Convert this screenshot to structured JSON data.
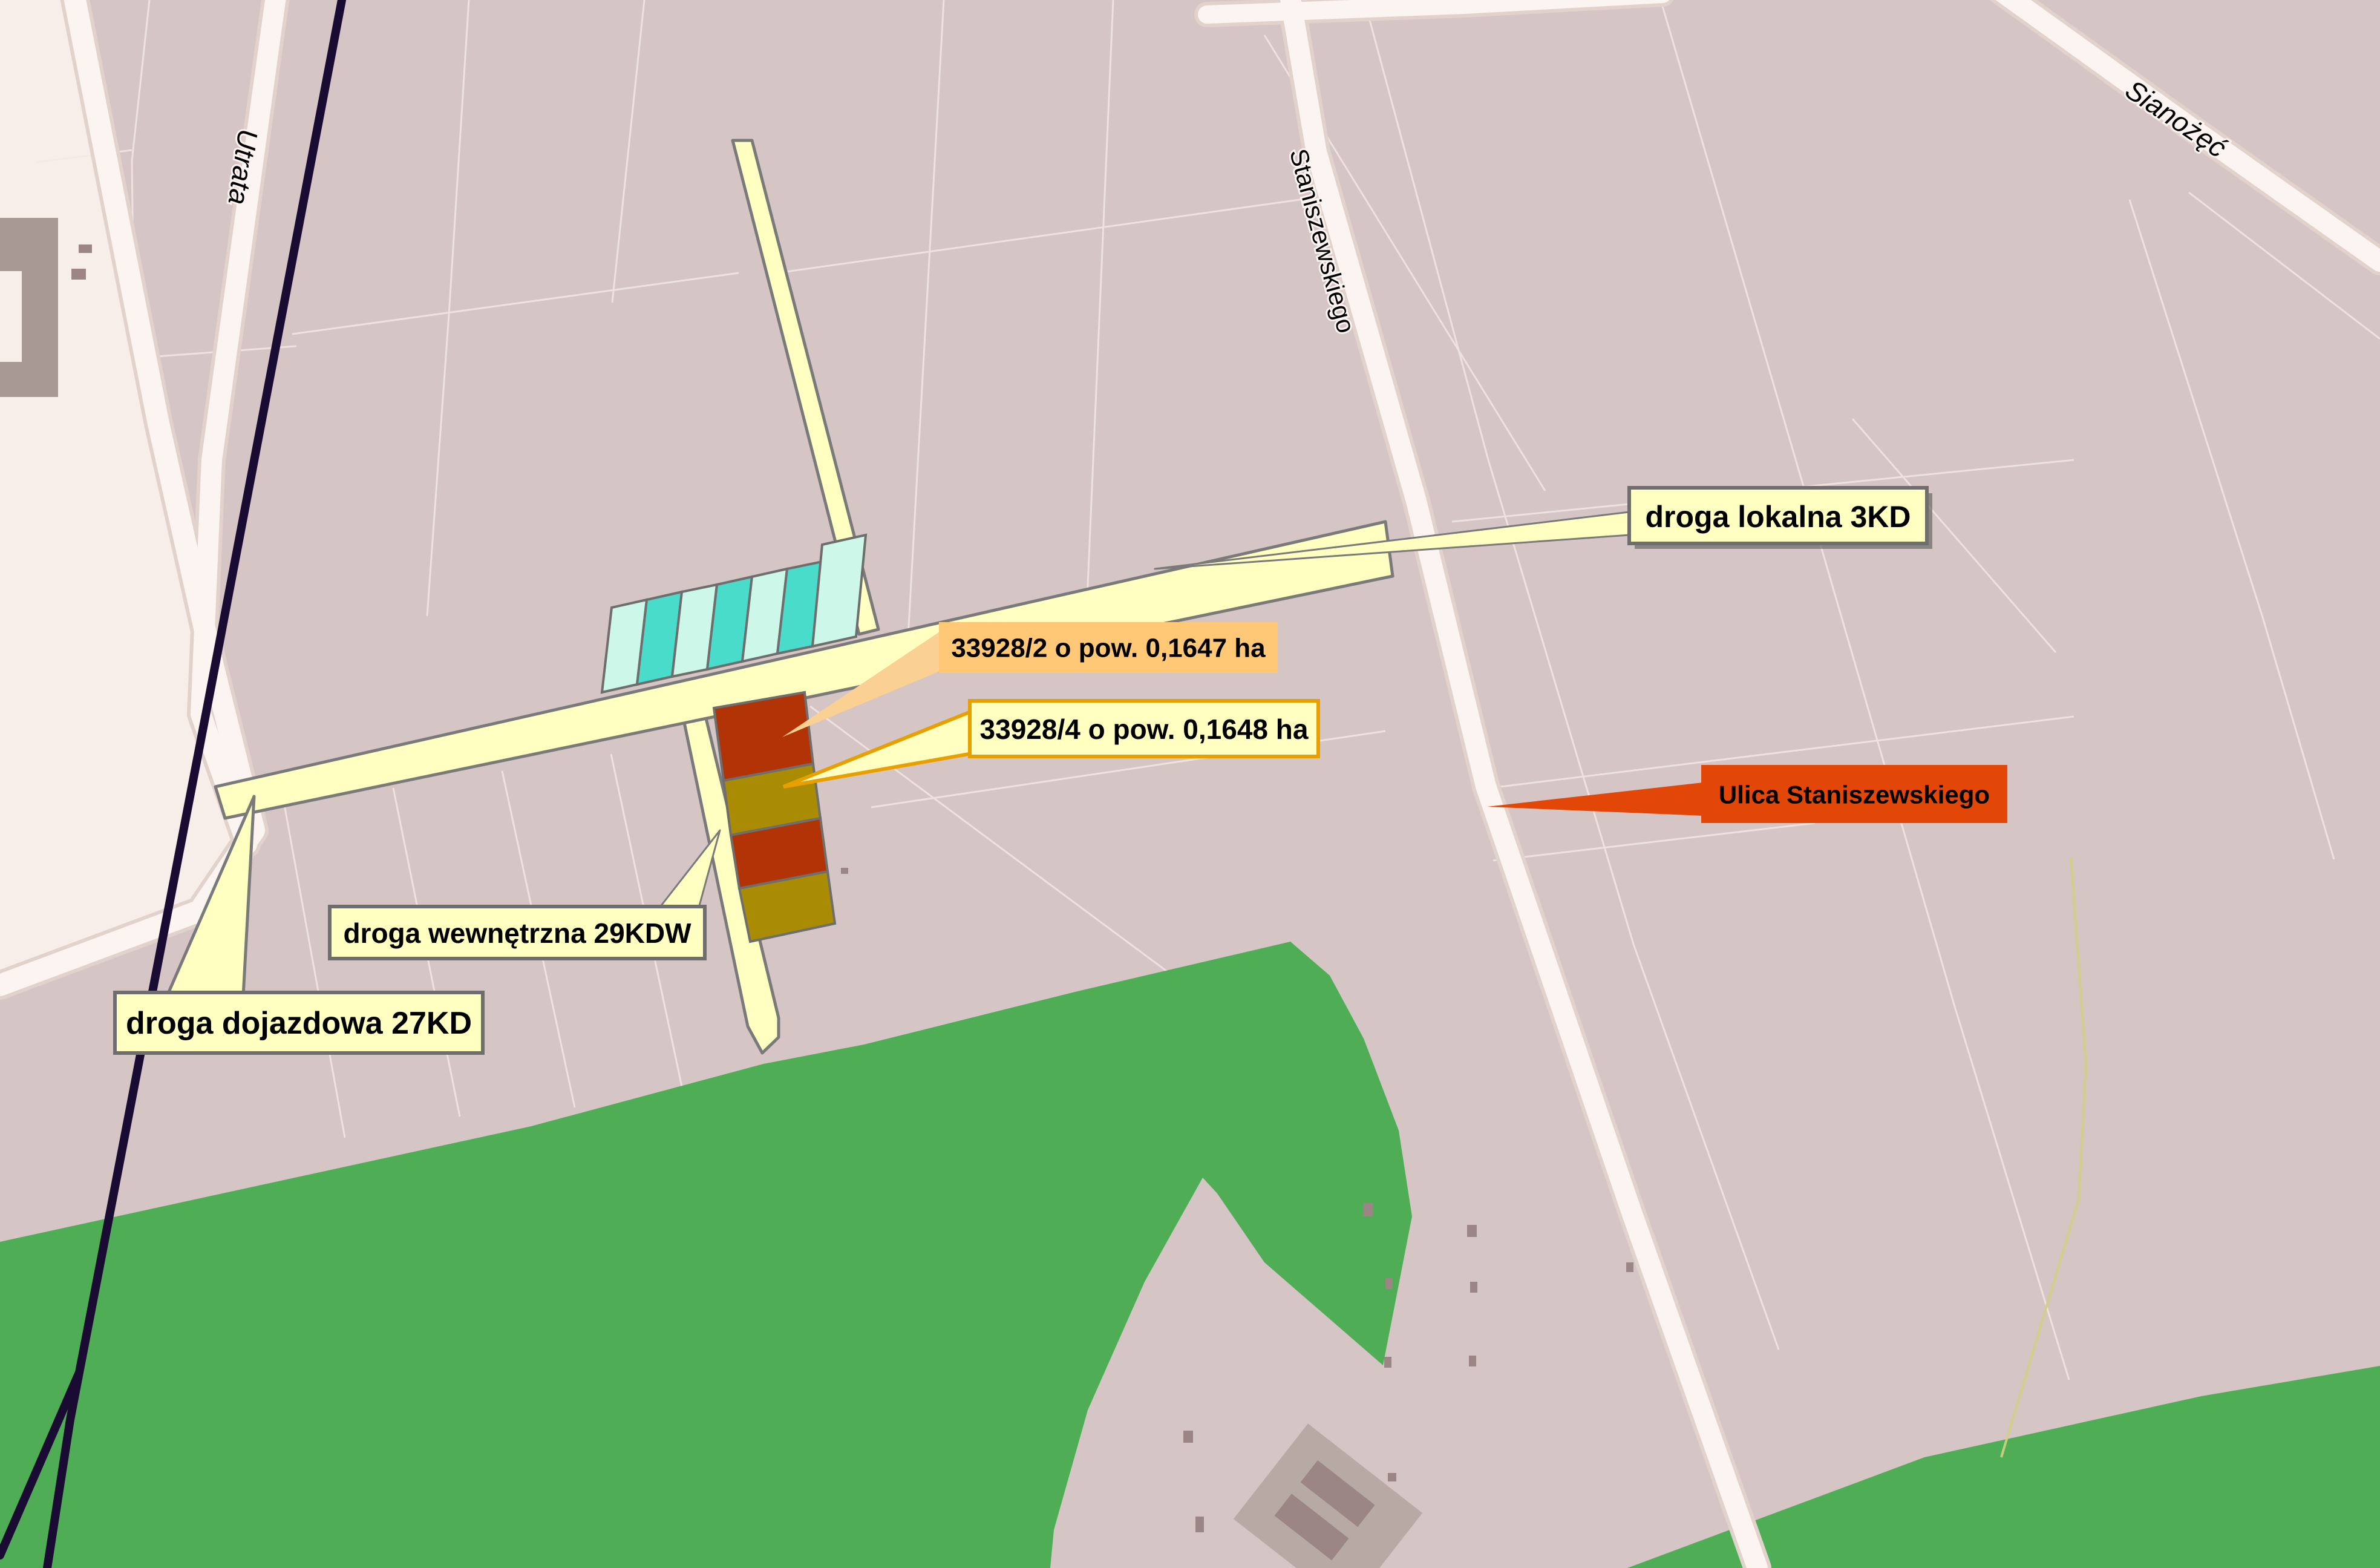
{
  "map": {
    "streets": [
      {
        "name": "Utrata"
      },
      {
        "name": "Staniszewskiego"
      },
      {
        "name": "Sianożęć"
      }
    ],
    "callouts": [
      {
        "id": "droga-lokalna-3kd",
        "label": "droga lokalna 3KD"
      },
      {
        "id": "parcel-33928-2",
        "label": "33928/2 o pow. 0,1647 ha"
      },
      {
        "id": "parcel-33928-4",
        "label": "33928/4 o pow. 0,1648 ha"
      },
      {
        "id": "ulica-staniszewskiego",
        "label": "Ulica Staniszewskiego"
      },
      {
        "id": "droga-wewnetrzna-29kdw",
        "label": "droga wewnętrzna 29KDW"
      },
      {
        "id": "droga-dojazdowa-27kd",
        "label": "droga dojazdowa 27KD"
      }
    ],
    "palette": {
      "base": "#d5c5c5",
      "pale_area": "#f7eeea",
      "parcel_line": "#f2e8e4",
      "olive_line": "#d2cf7f",
      "green": "#4fae55",
      "road_fill": "#fcf4f0",
      "road_casing": "#e2d2cc",
      "railway": "#1a0b33",
      "cream": "#ffffc1",
      "cream_border": "#7a7a7a",
      "cyan_light": "#cdf7e9",
      "cyan_bright": "#4adcca",
      "cyan_border": "#6e6e6e",
      "parcel_red": "#b23305",
      "parcel_olive": "#a98c04",
      "label_orange": "#fec876",
      "leader_orange": "#fbd093",
      "label_red": "#e24708",
      "label_border": "#6e6e6e",
      "label_border_orange": "#e8a000",
      "building": "#a79a95",
      "building_plot": "#b7a9a4",
      "building_dark": "#9b8585"
    }
  }
}
